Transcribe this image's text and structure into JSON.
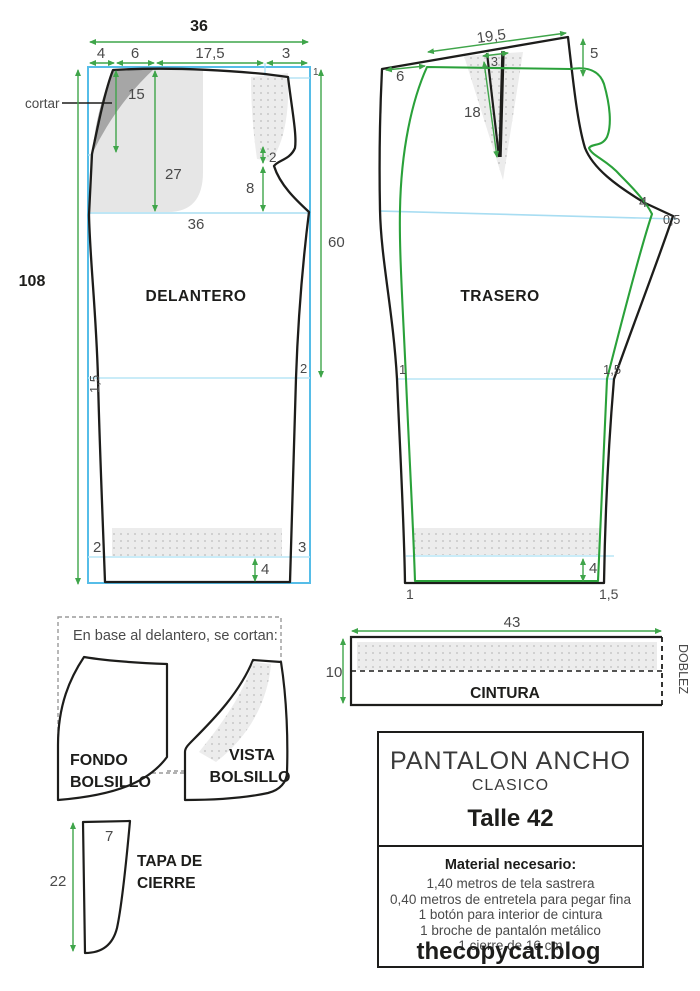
{
  "delantero": {
    "label": "DELANTERO",
    "cut_note": "cortar",
    "m": {
      "total_width": "36",
      "seg_a": "4",
      "seg_b": "6",
      "seg_c": "17,5",
      "seg_d": "3",
      "height": "108",
      "dart_depth": "15",
      "pocket_depth": "27",
      "hip_width": "36",
      "fly_top": "2",
      "fly_len": "8",
      "cf_drop": "1",
      "side_len": "60",
      "knee_left": "1,5",
      "knee_right": "2",
      "hem_left": "2",
      "hem_right": "3",
      "hem_fold": "4"
    }
  },
  "trasero": {
    "label": "TRASERO",
    "m": {
      "waist": "19,5",
      "dart_width": "3",
      "rise_ext": "5",
      "side_offset": "6",
      "dart_len": "18",
      "crotch_ext": "4",
      "crotch_drop": "0,5",
      "knee_left": "1",
      "knee_right": "1,5",
      "hem_fold": "4",
      "hem_left": "1",
      "hem_right": "1,5"
    }
  },
  "pockets": {
    "note": "En base al delantero, se cortan:",
    "fondo_line1": "FONDO",
    "fondo_line2": "BOLSILLO",
    "vista_line1": "VISTA",
    "vista_line2": "BOLSILLO",
    "tapa_line1": "TAPA DE",
    "tapa_line2": "CIERRE",
    "tapa_width": "7",
    "tapa_height": "22"
  },
  "cintura": {
    "label": "CINTURA",
    "width": "43",
    "height": "10",
    "fold_label": "DOBLEZ"
  },
  "info_box": {
    "title": "PANTALON ANCHO",
    "subtitle": "CLASICO",
    "size": "Talle 42",
    "materials_title": "Material necesario:",
    "materials": [
      "1,40 metros de tela sastrera",
      "0,40 metros de entretela para pegar fina",
      "1 botón para interior de cintura",
      "1 broche de pantalón metálico",
      "1 cierre de 16 cm"
    ]
  },
  "footer": {
    "site": "thecopycat.blog"
  },
  "colors": {
    "outline": "#1d1d1b",
    "overlay_green": "#2aa13a",
    "measure_green": "#3fa54a",
    "frame_blue": "#56bde8",
    "guide_blue": "#a8ddf2"
  }
}
